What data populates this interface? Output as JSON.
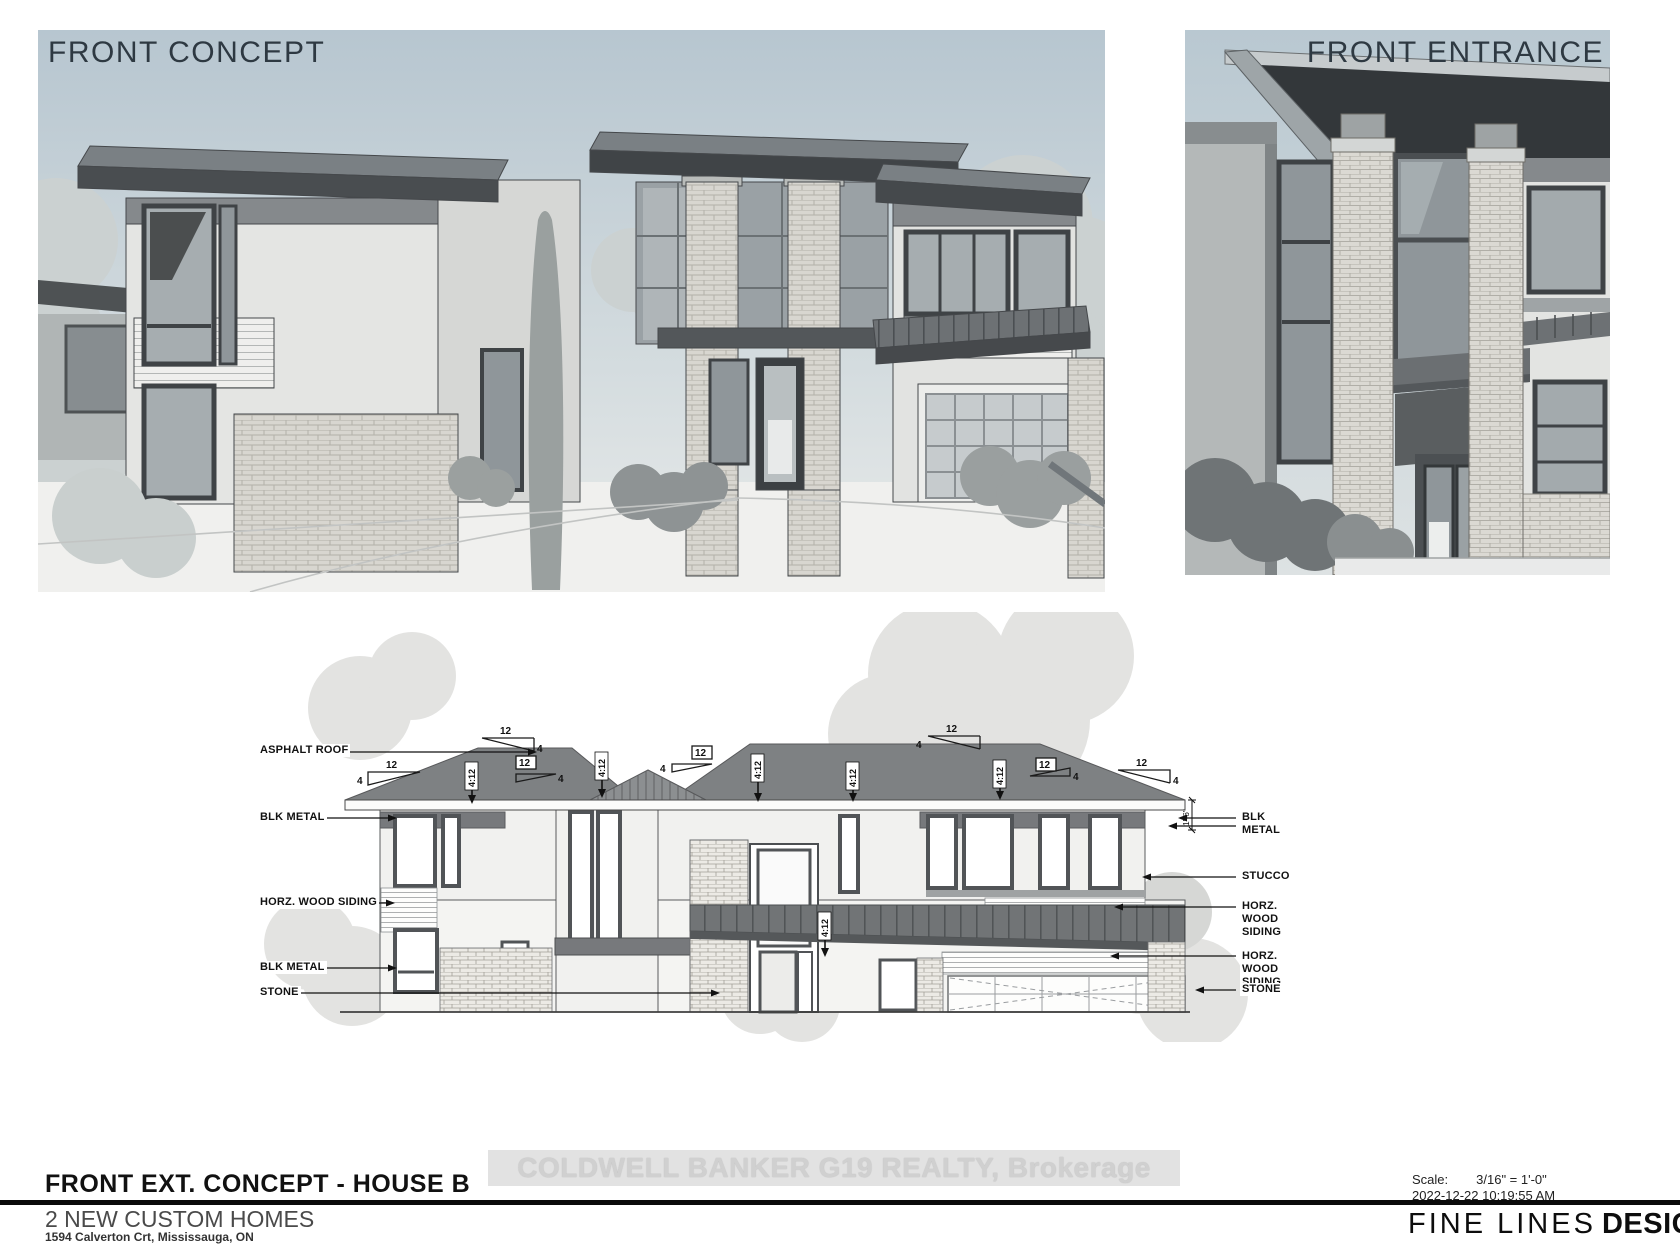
{
  "panels": {
    "front_concept": {
      "title": "FRONT CONCEPT"
    },
    "front_entrance": {
      "title": "FRONT ENTRANCE"
    }
  },
  "elevation": {
    "left_labels": [
      "ASPHALT ROOF",
      "BLK METAL",
      "HORZ. WOOD SIDING",
      "BLK METAL",
      "STONE"
    ],
    "right_labels": [
      "BLK METAL",
      "STUCCO",
      "HORZ. WOOD\nSIDING",
      "HORZ. WOOD\nSIDING",
      "STONE"
    ],
    "slope_rise": "12",
    "slope_run": "4",
    "slope_ratio": "4:12",
    "dim_fascia": "1'-6\""
  },
  "watermark": {
    "text": "COLDWELL BANKER G19 REALTY, Brokerage"
  },
  "titleblock": {
    "drawing_title": "FRONT EXT. CONCEPT - HOUSE B",
    "project_name": "2 NEW CUSTOM HOMES",
    "project_address": "1594 Calverton Crt, Mississauga, ON",
    "scale_label": "Scale:",
    "scale_value": "3/16\" = 1'-0\"",
    "datetime": "2022-12-22 10:19:55 AM",
    "firm_name_light": "FINE LINES",
    "firm_name_bold": "DESIGN"
  },
  "colors": {
    "sky_top": "#b7c6d0",
    "sky_bottom": "#e4e7e7",
    "roof_gray": "#7e8183",
    "dark_gray": "#45494c",
    "watermark_bg": "#e2e2e2",
    "watermark_text": "#d0d0d0"
  }
}
